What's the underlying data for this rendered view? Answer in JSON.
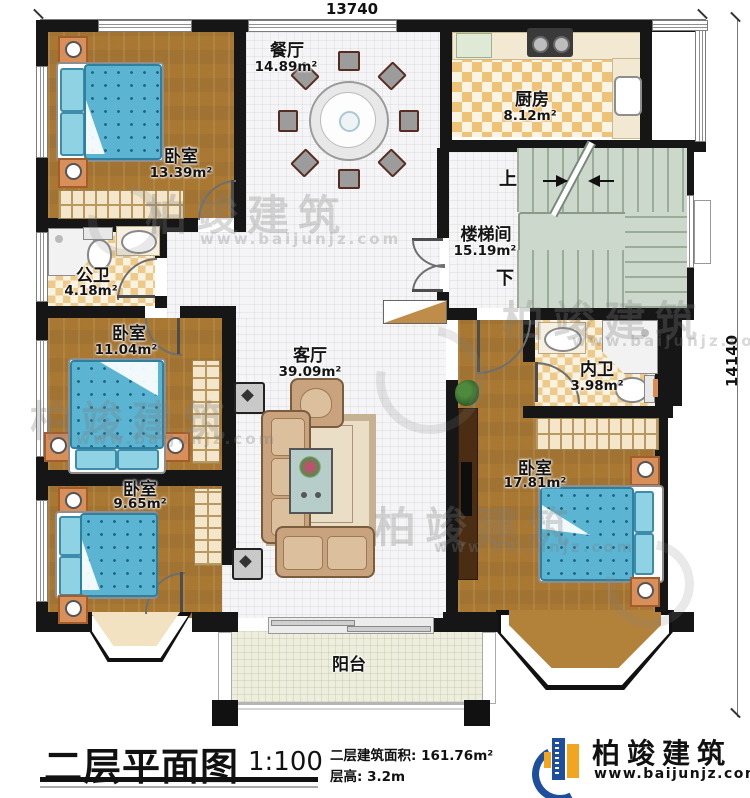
{
  "dimensions": {
    "top": "13740",
    "right": "14140"
  },
  "rooms": [
    {
      "id": "bedroom-top-left",
      "name": "卧室",
      "area": "13.39m²"
    },
    {
      "id": "dining",
      "name": "餐厅",
      "area": "14.89m²"
    },
    {
      "id": "kitchen",
      "name": "厨房",
      "area": "8.12m²"
    },
    {
      "id": "stairwell",
      "name": "楼梯间",
      "area": "15.19m²"
    },
    {
      "id": "public-bath",
      "name": "公卫",
      "area": "4.18m²"
    },
    {
      "id": "bedroom-mid-left",
      "name": "卧室",
      "area": "11.04m²"
    },
    {
      "id": "living",
      "name": "客厅",
      "area": "39.09m²"
    },
    {
      "id": "ensuite-bath",
      "name": "内卫",
      "area": "3.98m²"
    },
    {
      "id": "bedroom-bottom-right",
      "name": "卧室",
      "area": "17.81m²"
    },
    {
      "id": "bedroom-bottom-left",
      "name": "卧室",
      "area": "9.65m²"
    },
    {
      "id": "balcony",
      "name": "阳台"
    }
  ],
  "stairs": {
    "up": "上",
    "down": "下"
  },
  "title_block": {
    "title": "二层平面图",
    "scale": "1:100",
    "area_label": "二层建筑面积:",
    "area_value": "161.76m²",
    "height_label": "层高:",
    "height_value": "3.2m"
  },
  "brand": {
    "name": "柏竣建筑",
    "url": "www.baijunjz.com"
  },
  "watermark": {
    "name": "柏竣建筑",
    "url": "www.baijunjz.com"
  },
  "colors": {
    "wall": "#161616",
    "wood_floor": "#b2813a",
    "bed_blue": "#5bb5d2",
    "brand_blue": "#1d4f9e",
    "brand_orange": "#f2a51f"
  }
}
